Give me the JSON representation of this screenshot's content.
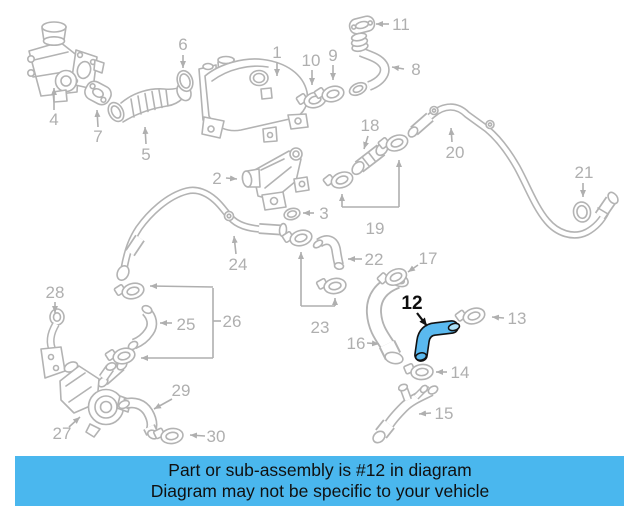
{
  "caption": {
    "line1": "Part or sub-assembly is #12 in diagram",
    "line2": "Diagram may not be specific to your vehicle",
    "bg_color": "#4ab7ee",
    "text_color": "#101010"
  },
  "highlight": {
    "label": "12",
    "part_color": "#5ab9ef",
    "cap_color": "#ace0f7",
    "outline_color": "#111111"
  },
  "diagram": {
    "line_color": "#b3b3b3",
    "label_color": "#afafaf",
    "description": "Exploded engine cooling / EGR hose parts diagram with numbered callouts"
  },
  "callouts": [
    "1",
    "2",
    "3",
    "4",
    "5",
    "6",
    "7",
    "8",
    "9",
    "10",
    "11",
    "12",
    "13",
    "14",
    "15",
    "16",
    "17",
    "18",
    "19",
    "20",
    "21",
    "22",
    "23",
    "24",
    "25",
    "26",
    "27",
    "28",
    "29",
    "30"
  ]
}
